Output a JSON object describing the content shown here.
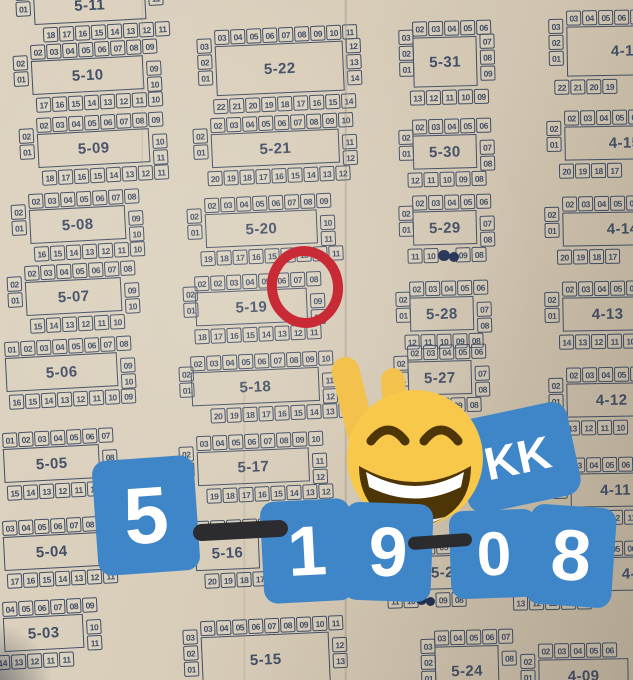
{
  "colors": {
    "paper": "#d6cab6",
    "ink": "#414e66",
    "sticker_blue": "#3f86c9",
    "sticker_text": "#ffffff",
    "marker_black": "#2b2b30",
    "circle_red": "#c92b36",
    "emoji_yellow": "#f8c84a",
    "emoji_brown": "#4e3505",
    "pen_ink": "#223055"
  },
  "stickers": {
    "kk": "KK",
    "digits": [
      "5",
      "1",
      "9",
      "0",
      "8"
    ]
  },
  "circled_seats": {
    "block": "5-19",
    "seats": [
      "07",
      "08"
    ]
  },
  "blocks": [
    {
      "label": "5-11",
      "x": 14,
      "y": -24,
      "rot": -3,
      "top": [
        "02",
        "03",
        "04",
        "05",
        "06",
        "07",
        "08",
        "09"
      ],
      "left": [
        "02",
        "01"
      ],
      "right": [
        "11"
      ],
      "bottom": [
        "18",
        "17",
        "16",
        "15",
        "14",
        "13",
        "12",
        "11"
      ]
    },
    {
      "label": "5-10",
      "x": 12,
      "y": 46,
      "rot": -3,
      "bi": 21,
      "top": [
        "02",
        "03",
        "04",
        "05",
        "06",
        "07",
        "08",
        "09"
      ],
      "left": [
        "02",
        "01"
      ],
      "right": [
        "09",
        "10"
      ],
      "bottom": [
        "17",
        "16",
        "15",
        "14",
        "13",
        "12",
        "11",
        "10"
      ]
    },
    {
      "label": "5-09",
      "x": 18,
      "y": 119,
      "rot": -3,
      "bi": 21,
      "top": [
        "02",
        "03",
        "04",
        "05",
        "06",
        "07",
        "08",
        "09"
      ],
      "left": [
        "02",
        "01"
      ],
      "right": [
        "10",
        "11"
      ],
      "bottom": [
        "18",
        "17",
        "16",
        "15",
        "14",
        "13",
        "12",
        "11"
      ]
    },
    {
      "label": "5-08",
      "x": 10,
      "y": 195,
      "rot": -3,
      "bi": 21,
      "top": [
        "02",
        "03",
        "04",
        "05",
        "06",
        "07",
        "08"
      ],
      "left": [
        "02",
        "01"
      ],
      "right": [
        "09",
        "10"
      ],
      "bottom": [
        "16",
        "15",
        "14",
        "13",
        "12",
        "11",
        "10"
      ]
    },
    {
      "label": "5-07",
      "x": 6,
      "y": 267,
      "rot": -3,
      "bi": 21,
      "top": [
        "02",
        "03",
        "04",
        "05",
        "06",
        "07",
        "08"
      ],
      "left": [
        "02",
        "01"
      ],
      "right": [
        "09",
        "10"
      ],
      "bottom": [
        "15",
        "14",
        "13",
        "12",
        "11",
        "10"
      ]
    },
    {
      "label": "5-06",
      "x": -14,
      "y": 343,
      "rot": -3,
      "bi": 20,
      "top": [
        "01",
        "02",
        "03",
        "04",
        "05",
        "06",
        "07",
        "08"
      ],
      "left": [],
      "right": [
        "09",
        "10"
      ],
      "bottom": [
        "16",
        "15",
        "14",
        "13",
        "12",
        "11",
        "10",
        "09"
      ]
    },
    {
      "label": "5-05",
      "x": -16,
      "y": 434,
      "rot": -3,
      "bi": 20,
      "top": [
        "01",
        "02",
        "03",
        "04",
        "05",
        "06",
        "07"
      ],
      "left": [],
      "right": [
        "08"
      ],
      "bottom": [
        "15",
        "14",
        "13",
        "12",
        "11",
        "10",
        "09"
      ]
    },
    {
      "label": "5-04",
      "x": -16,
      "y": 522,
      "rot": -3,
      "bi": 20,
      "top": [
        "03",
        "04",
        "05",
        "06",
        "07",
        "08",
        "09"
      ],
      "left": [],
      "right": [
        "10"
      ],
      "bottom": [
        "17",
        "16",
        "15",
        "14",
        "13",
        "12",
        "11"
      ]
    },
    {
      "label": "5-03",
      "x": -16,
      "y": 603,
      "rot": -3,
      "bi": 8,
      "top": [
        "04",
        "05",
        "06",
        "07",
        "08",
        "09"
      ],
      "left": [],
      "right": [
        "10",
        "11"
      ],
      "bottom": [
        "14",
        "13",
        "12",
        "11",
        "11"
      ]
    },
    {
      "label": "5-22",
      "x": 196,
      "y": 31,
      "rot": -2.5,
      "lh": 50,
      "bi": 14,
      "top": [
        "03",
        "04",
        "05",
        "06",
        "07",
        "08",
        "09",
        "10",
        "11"
      ],
      "left": [
        "03",
        "02",
        "01"
      ],
      "right": [
        "12",
        "13",
        "14"
      ],
      "bottom": [
        "22",
        "21",
        "20",
        "19",
        "18",
        "17",
        "16",
        "15",
        "14"
      ]
    },
    {
      "label": "5-21",
      "x": 192,
      "y": 119,
      "rot": -2.5,
      "bi": 13,
      "top": [
        "02",
        "03",
        "04",
        "05",
        "06",
        "07",
        "08",
        "09",
        "10"
      ],
      "left": [
        "02",
        "01"
      ],
      "right": [
        "11",
        "12"
      ],
      "bottom": [
        "20",
        "19",
        "18",
        "17",
        "16",
        "15",
        "14",
        "13",
        "12"
      ]
    },
    {
      "label": "5-20",
      "x": 186,
      "y": 199,
      "rot": -2.5,
      "bi": 12,
      "top": [
        "02",
        "03",
        "04",
        "05",
        "06",
        "07",
        "08",
        "09"
      ],
      "left": [
        "02",
        "01"
      ],
      "right": [
        "10",
        "11"
      ],
      "bottom": [
        "19",
        "18",
        "17",
        "16",
        "15",
        "14",
        "13",
        "12",
        "11"
      ]
    },
    {
      "label": "5-19",
      "x": 182,
      "y": 277,
      "rot": -2.5,
      "ti": 12,
      "bi": 10,
      "top": [
        "02",
        "02",
        "03",
        "04",
        "05",
        "06",
        "07",
        "08"
      ],
      "left": [
        "02",
        "01"
      ],
      "right": [
        "09",
        "10"
      ],
      "bottom": [
        "18",
        "17",
        "16",
        "15",
        "14",
        "13",
        "12",
        "11"
      ]
    },
    {
      "label": "5-18",
      "x": 178,
      "y": 357,
      "rot": -2.5,
      "ti": 12,
      "bi": 30,
      "top": [
        "02",
        "03",
        "04",
        "05",
        "06",
        "07",
        "08",
        "09",
        "10"
      ],
      "left": [
        "02",
        "01"
      ],
      "right": [
        "11",
        "12"
      ],
      "bottom": [
        "20",
        "19",
        "18",
        "17",
        "16",
        "15",
        "14",
        "13",
        "12"
      ]
    },
    {
      "label": "5-17",
      "x": 178,
      "y": 437,
      "rot": -2.5,
      "top": [
        "03",
        "04",
        "05",
        "06",
        "07",
        "08",
        "09",
        "10"
      ],
      "left": [
        "02",
        "01"
      ],
      "right": [
        "11",
        "12"
      ],
      "bottom": [
        "19",
        "18",
        "17",
        "16",
        "15",
        "14",
        "13",
        "12"
      ]
    },
    {
      "label": "5-16",
      "x": 176,
      "y": 522,
      "rot": -2.5,
      "top": [
        "03",
        "04",
        "05",
        "06",
        "07"
      ],
      "left": [
        "02",
        "01"
      ],
      "right": [],
      "bottom": [
        "20",
        "19",
        "18",
        "17",
        "16",
        "15"
      ]
    },
    {
      "label": "5-15",
      "x": 182,
      "y": 622,
      "rot": -2.5,
      "lh": 50,
      "bi": 18,
      "top": [
        "03",
        "04",
        "05",
        "06",
        "07",
        "08",
        "09",
        "10",
        "11"
      ],
      "left": [
        "03",
        "02",
        "01"
      ],
      "right": [
        "12",
        "13"
      ],
      "bottom": []
    },
    {
      "label": "5-31",
      "x": 398,
      "y": 22,
      "rot": -1.5,
      "lh": 50,
      "ti": 14,
      "bi": 10,
      "top": [
        "02",
        "03",
        "04",
        "05",
        "06"
      ],
      "left": [
        "03",
        "02",
        "01"
      ],
      "right": [
        "07",
        "08",
        "09"
      ],
      "bottom": [
        "13",
        "12",
        "11",
        "10",
        "09"
      ]
    },
    {
      "label": "5-30",
      "x": 398,
      "y": 120,
      "rot": -1.5,
      "ti": 14,
      "bi": 8,
      "top": [
        "02",
        "03",
        "04",
        "05",
        "06"
      ],
      "left": [
        "02",
        "01"
      ],
      "right": [
        "07",
        "08"
      ],
      "bottom": [
        "12",
        "11",
        "10",
        "09",
        "08"
      ]
    },
    {
      "label": "5-29",
      "x": 398,
      "y": 196,
      "rot": -1.5,
      "ti": 14,
      "bi": 8,
      "top": [
        "02",
        "03",
        "04",
        "05",
        "06"
      ],
      "left": [
        "02",
        "01"
      ],
      "right": [
        "07",
        "08"
      ],
      "bottom": [
        "11",
        "10",
        "_",
        "09",
        "08"
      ]
    },
    {
      "label": "5-28",
      "x": 395,
      "y": 282,
      "rot": -1.5,
      "ti": 14,
      "bi": 8,
      "top": [
        "02",
        "03",
        "04",
        "05",
        "06"
      ],
      "left": [
        "02",
        "01"
      ],
      "right": [
        "07",
        "08"
      ],
      "bottom": [
        "12",
        "11",
        "10",
        "09",
        "08"
      ]
    },
    {
      "label": "5-27",
      "x": 393,
      "y": 346,
      "rot": -1.5,
      "ti": 14,
      "bi": 8,
      "top": [
        "02",
        "03",
        "04",
        "05",
        "06"
      ],
      "left": [
        "02",
        "01"
      ],
      "right": [
        "07",
        "08"
      ],
      "bottom": [
        "12",
        "11",
        "10",
        "09",
        "08"
      ]
    },
    {
      "label": "5-25",
      "x": 378,
      "y": 541,
      "rot": -1.5,
      "ti": 42,
      "lw": 52,
      "bi": 8,
      "top": [
        "04",
        "05",
        "06"
      ],
      "left": [],
      "right": [
        "07",
        "08"
      ],
      "bottom": [
        "11",
        "10",
        "_",
        "09",
        "08"
      ]
    },
    {
      "label": "5-24",
      "x": 420,
      "y": 631,
      "rot": -1.5,
      "lh": 50,
      "ti": 14,
      "bi": 14,
      "top": [
        "03",
        "04",
        "05",
        "06",
        "07"
      ],
      "left": [
        "03",
        "02",
        "01"
      ],
      "right": [
        "08"
      ],
      "bottom": []
    },
    {
      "label": "4-16",
      "x": 548,
      "y": 11,
      "rot": -1,
      "lh": 50,
      "lw": 120,
      "bi": 5,
      "top": [
        "03",
        "04",
        "05",
        "06",
        "07"
      ],
      "left": [
        "03",
        "02",
        "01"
      ],
      "right": [],
      "bottom": [
        "22",
        "21",
        "20",
        "19"
      ]
    },
    {
      "label": "4-15",
      "x": 546,
      "y": 111,
      "rot": -1,
      "lw": 120,
      "bi": 12,
      "top": [
        "02",
        "03",
        "04",
        "05",
        "06"
      ],
      "left": [
        "02",
        "01"
      ],
      "right": [],
      "bottom": [
        "20",
        "19",
        "18",
        "17"
      ]
    },
    {
      "label": "4-14",
      "x": 544,
      "y": 197,
      "rot": -1,
      "lw": 120,
      "bi": 12,
      "top": [
        "02",
        "03",
        "04",
        "05",
        "06"
      ],
      "left": [
        "02",
        "01"
      ],
      "right": [],
      "bottom": [
        "20",
        "19",
        "18",
        "17"
      ]
    },
    {
      "label": "4-13",
      "x": 544,
      "y": 282,
      "rot": -1,
      "lw": 90,
      "bi": 14,
      "top": [
        "02",
        "03",
        "04",
        "05",
        "06"
      ],
      "left": [
        "02",
        "01"
      ],
      "right": [],
      "bottom": [
        "14",
        "13",
        "12",
        "11",
        "10"
      ]
    },
    {
      "label": "4-12",
      "x": 548,
      "y": 368,
      "rot": -1,
      "lw": 90,
      "bi": 0,
      "top": [
        "02",
        "03",
        "04",
        "05",
        "06"
      ],
      "left": [
        "02",
        "01"
      ],
      "right": [],
      "bottom": [
        "14",
        "13",
        "12",
        "11",
        "10"
      ]
    },
    {
      "label": "4-11",
      "x": 552,
      "y": 458,
      "rot": -1,
      "lw": 90,
      "bi": 23,
      "top": [
        "03",
        "04",
        "05",
        "06",
        "07"
      ],
      "left": [
        "02",
        "01"
      ],
      "right": [],
      "bottom": [
        "14",
        "13",
        "12",
        "11"
      ]
    },
    {
      "label": "4-10",
      "x": 552,
      "y": 542,
      "rot": -1,
      "ti": 40,
      "lw": 90,
      "bi": -40,
      "top": [
        "04",
        "05",
        "06"
      ],
      "left": [],
      "right": [],
      "bottom": [
        "13",
        "12",
        "11",
        "10",
        "09"
      ]
    },
    {
      "label": "4-09",
      "x": 520,
      "y": 644,
      "rot": -1,
      "lw": 90,
      "top": [
        "02",
        "03",
        "04",
        "05",
        "06"
      ],
      "left": [
        "02",
        "01"
      ],
      "right": [],
      "bottom": []
    }
  ]
}
